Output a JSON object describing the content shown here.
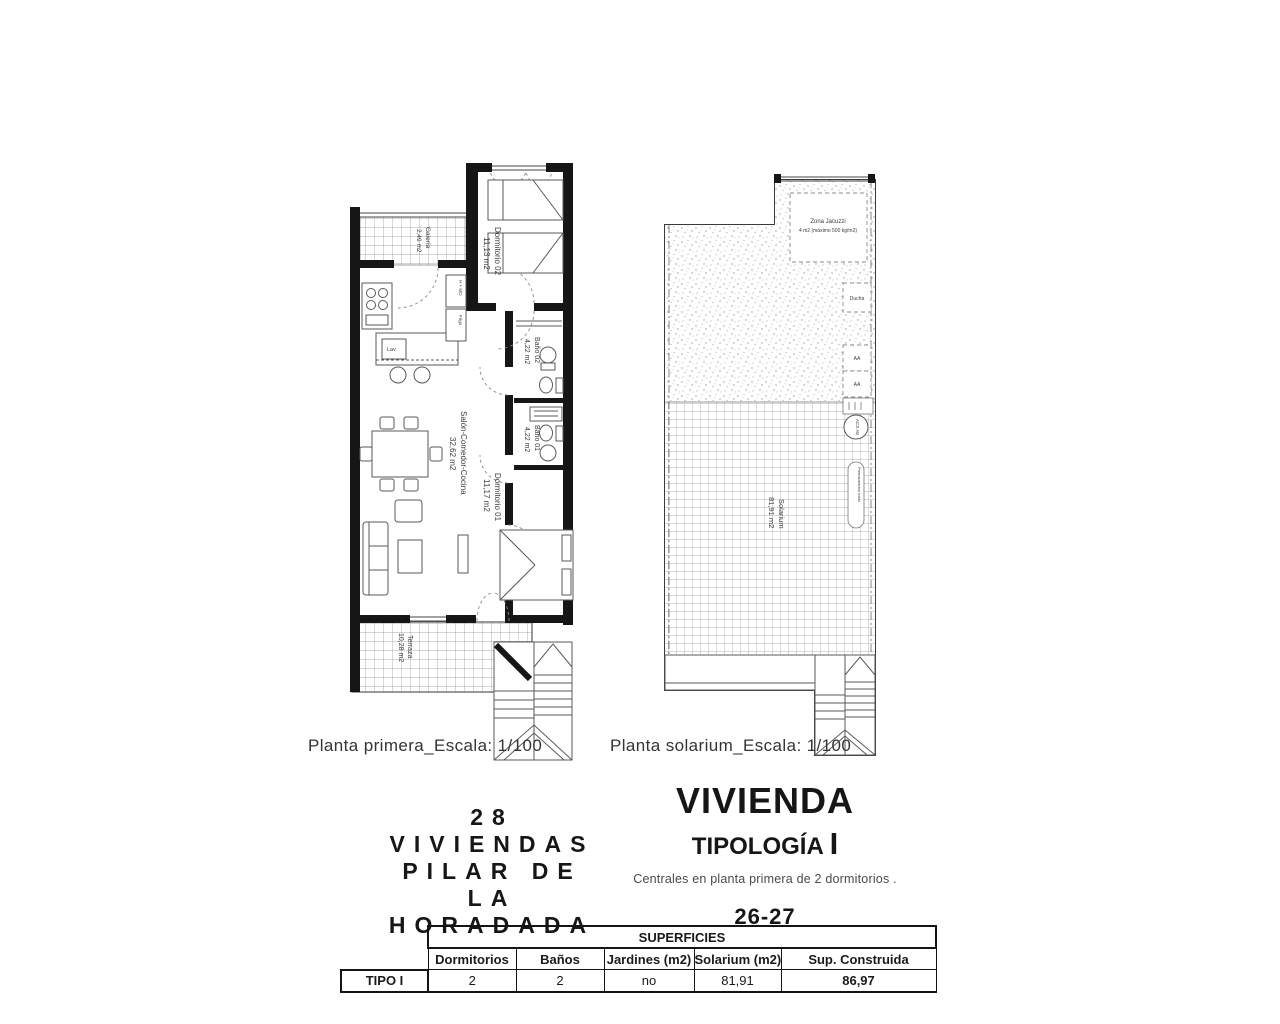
{
  "ink": "#161616",
  "plan_first": {
    "caption": "Planta primera_Escala: 1/100",
    "galeria_name": "Galería",
    "galeria_area": "2,49 m2",
    "dorm2_name": "Dormitorio 02",
    "dorm2_area": "11,13 m2",
    "bano2_name": "Baño 02",
    "bano2_area": "4,22 m2",
    "bano1_name": "Baño 01",
    "bano1_area": "4,22 m2",
    "dorm1_name": "Dormitorio 01",
    "dorm1_area": "11,17 m2",
    "salon_name": "Salón-Comedor-Cocina",
    "salon_area": "32,62 m2",
    "terraza_name": "Terraza",
    "terraza_area": "10,28 m2",
    "appliance_hmo": "H + MO",
    "appliance_frigo": "Frigo",
    "appliance_lav": "Lav"
  },
  "plan_solarium": {
    "caption": "Planta solarium_Escala: 1/100",
    "jacuzzi_line1": "Zona Jacuzzi",
    "jacuzzi_line2": "4 m2 (máximo 500 kg/m2)",
    "ducha": "Ducha",
    "aa": "AA",
    "acs": "ACS AE",
    "solarium_name": "Solarium",
    "solarium_area": "81,91 m2",
    "toldo": "Preinstalación toldo"
  },
  "title_block": {
    "project_line1": "28 VIVIENDAS",
    "project_line2": "PILAR DE LA",
    "project_line3": "HORADADA",
    "dwelling": "VIVIENDA",
    "typology": "TIPOLOGÍA",
    "typology_mark": "I",
    "description": "Centrales en planta primera de 2 dormitorios .",
    "units": "26-27"
  },
  "table": {
    "group_header": "SUPERFICIES",
    "row_label": "TIPO I",
    "col_dormitorios": "Dormitorios",
    "col_banos": "Baños",
    "col_jardines": "Jardines (m2)",
    "col_solarium": "Solarium (m2)",
    "col_sup": "Sup. Construida",
    "val_dormitorios": "2",
    "val_banos": "2",
    "val_jardines": "no",
    "val_solarium": "81,91",
    "val_sup": "86,97"
  }
}
